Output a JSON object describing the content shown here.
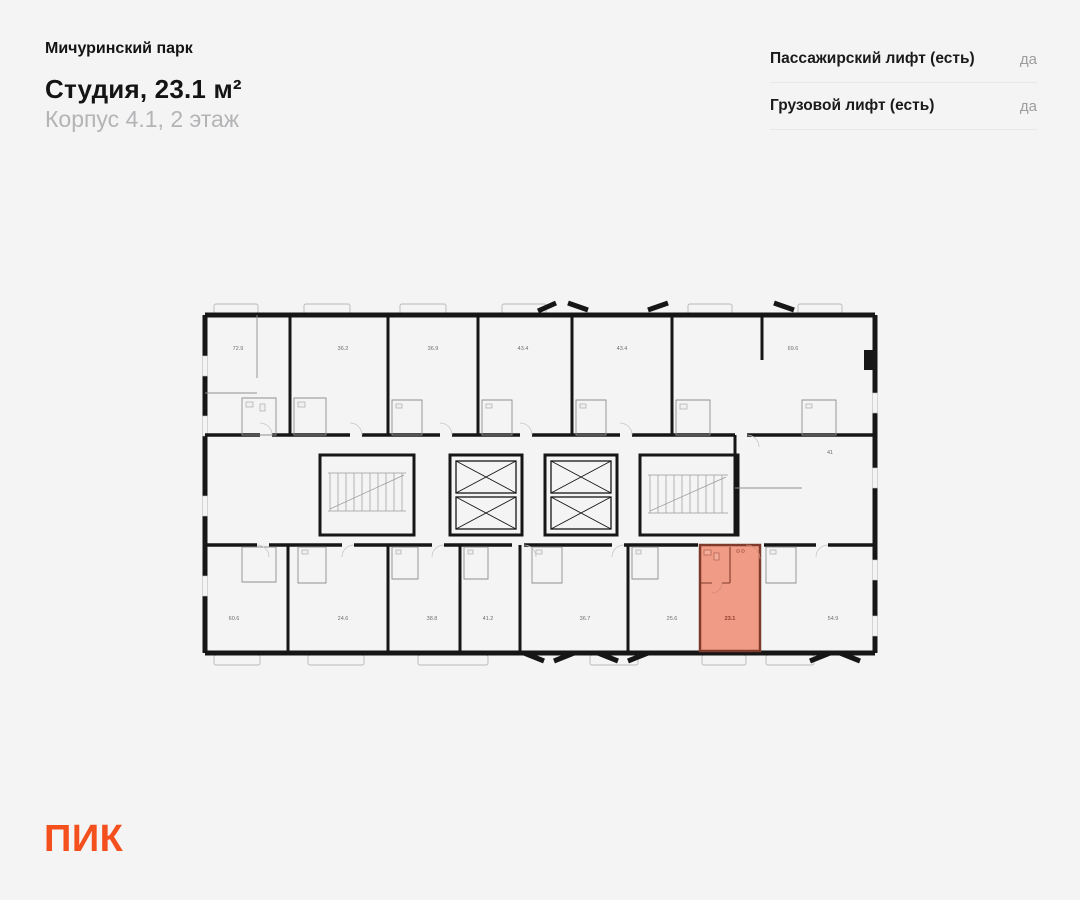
{
  "header": {
    "project_name": "Мичуринский парк",
    "apartment_title": "Студия, 23.1 м²",
    "apartment_subtitle": "Корпус 4.1, 2 этаж"
  },
  "features": {
    "rows": [
      {
        "label": "Пассажирский лифт (есть)",
        "value": "да"
      },
      {
        "label": "Грузовой лифт (есть)",
        "value": "да"
      }
    ]
  },
  "floorplan": {
    "type": "floor-plan",
    "floor": "2",
    "building": "4.1",
    "highlighted_unit": {
      "label": "23.1",
      "fill": "#F09B85",
      "border": "#7E3B2C",
      "label_color": "#8F3B2A"
    },
    "top_row_areas": [
      "72.9",
      "36.2",
      "36.9",
      "43.4",
      "43.4",
      "69.6"
    ],
    "bottom_row_areas": [
      "60.6",
      "24.6",
      "38.8",
      "41.2",
      "36.7",
      "25.6",
      "23.1",
      "54.9"
    ],
    "middle_areas": [
      "41"
    ]
  },
  "logo": {
    "text": "ПИК",
    "color": "#F4501E"
  }
}
